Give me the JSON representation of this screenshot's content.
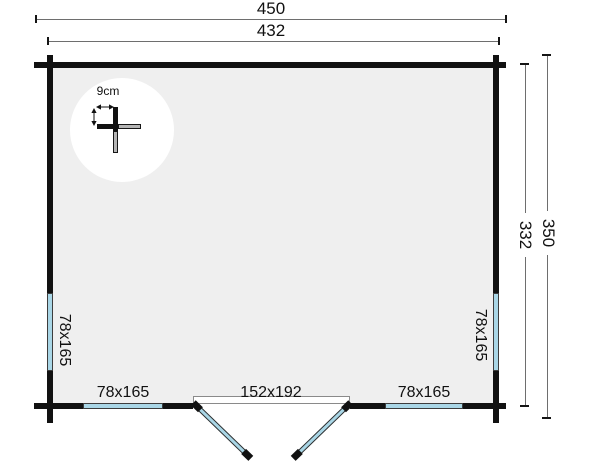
{
  "dimensions": {
    "top_outer": "450",
    "top_inner": "432",
    "right_inner": "332",
    "right_outer": "350"
  },
  "detail": {
    "wall_thickness": "9cm"
  },
  "openings": {
    "left_window": "78x165",
    "right_window": "78x165",
    "bottom_left_window": "78x165",
    "bottom_right_window": "78x165",
    "door": "152x192"
  },
  "colors": {
    "background": "#ffffff",
    "wall": "#111111",
    "floor": "#efefef",
    "window": "#a9d6e6",
    "dimension_line": "#6e6e6e",
    "detail_gray": "#b5b5b5"
  }
}
